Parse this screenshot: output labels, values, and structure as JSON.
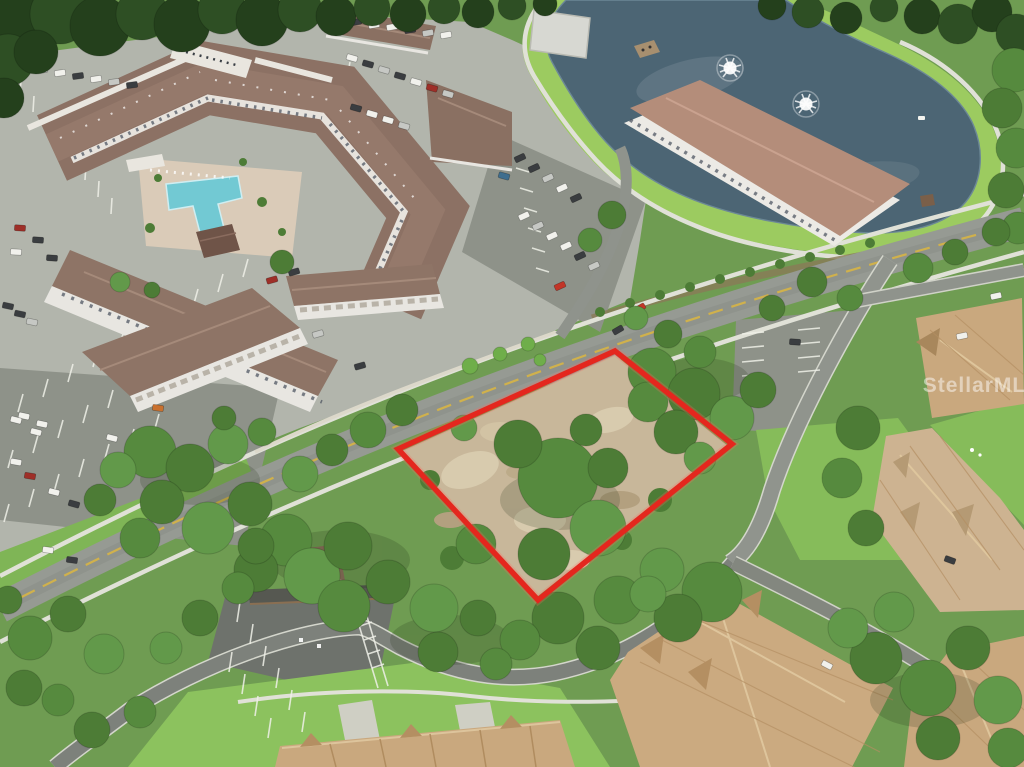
{
  "watermark": {
    "text": "StellarMLS"
  },
  "scene": {
    "kind": "aerial-drone-photo",
    "subject": "vacant-land-parcel-outlined-in-red",
    "features": [
      "apartment-complex-with-courtyard-pool",
      "retention-pond-with-two-fountains",
      "parking-lots-with-cars",
      "tree-canopy",
      "tan-roof-townhomes",
      "curving-residential-roads"
    ],
    "counts": {
      "fountains": 2
    },
    "colors": {
      "boundary_red": "#e4271e",
      "boundary_glow": "#ff6a5e",
      "pond_water": "#4c6574",
      "pond_bank": "#9ccb60",
      "pool_water": "#72c9d3",
      "canopy_green": "#4d7c36",
      "lawn_green": "#8cc25e",
      "roof_brown": "#8c7164",
      "roof_pink": "#b48d7a",
      "roof_tan": "#c9a87e",
      "asphalt_gray": "#969a93",
      "dirt_tan": "#c8b79a",
      "sidewalk": "#e3e3da"
    }
  }
}
